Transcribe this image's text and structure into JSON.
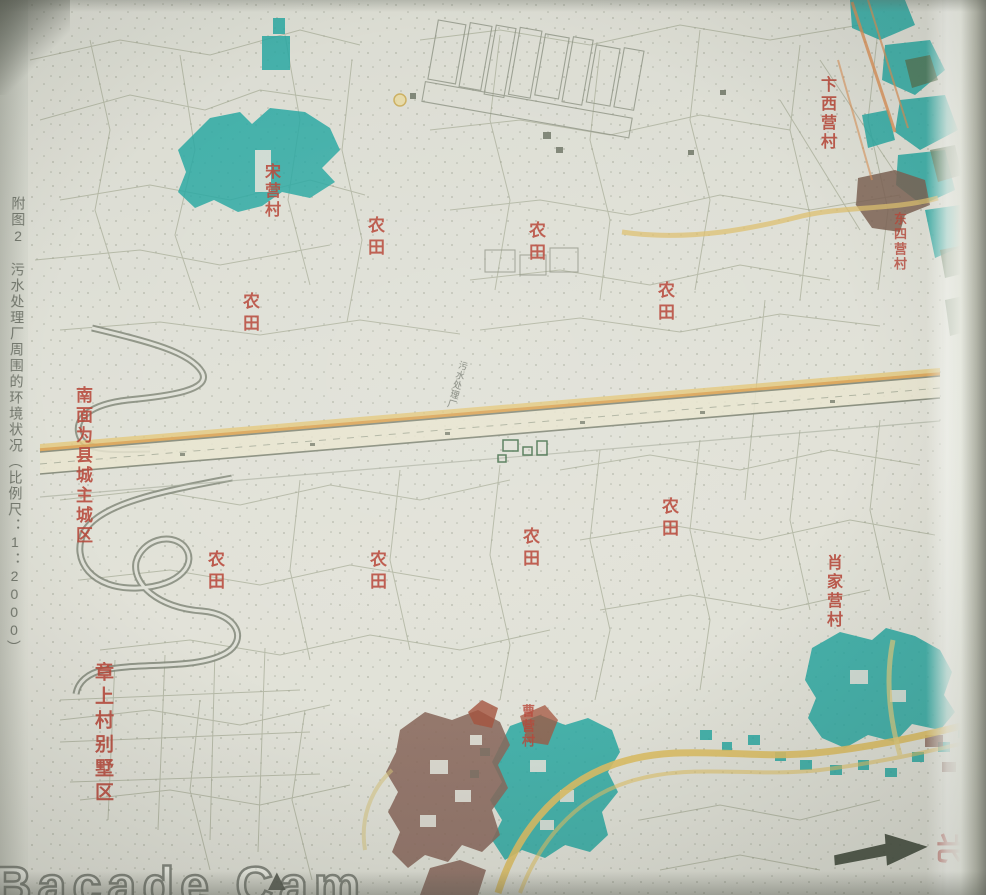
{
  "page": {
    "caption": "附图2　污水处理厂周围的环境状况（比例尺：1：2000）"
  },
  "map": {
    "labels": [
      {
        "name": "label-farmland-1",
        "text": "农田",
        "type": "farmland",
        "x": 366,
        "y": 216
      },
      {
        "name": "label-farmland-2",
        "text": "农田",
        "type": "farmland",
        "x": 527,
        "y": 221
      },
      {
        "name": "label-farmland-3",
        "text": "农田",
        "type": "farmland",
        "x": 656,
        "y": 281
      },
      {
        "name": "label-farmland-4",
        "text": "农田",
        "type": "farmland",
        "x": 241,
        "y": 292
      },
      {
        "name": "label-farmland-5",
        "text": "农田",
        "type": "farmland",
        "x": 206,
        "y": 550
      },
      {
        "name": "label-farmland-6",
        "text": "农田",
        "type": "farmland",
        "x": 368,
        "y": 550
      },
      {
        "name": "label-farmland-7",
        "text": "农田",
        "type": "farmland",
        "x": 521,
        "y": 527
      },
      {
        "name": "label-farmland-8",
        "text": "农田",
        "type": "farmland",
        "x": 660,
        "y": 497
      },
      {
        "name": "label-village-song",
        "text": "宋营村",
        "type": "village",
        "x": 262,
        "y": 163
      },
      {
        "name": "label-village-bianxi",
        "text": "卞西营村",
        "type": "village",
        "x": 818,
        "y": 76
      },
      {
        "name": "label-village-dongsi",
        "text": "东四营村",
        "type": "village-sm",
        "x": 893,
        "y": 212
      },
      {
        "name": "label-village-xiaojia",
        "text": "肖家营村",
        "type": "village",
        "x": 824,
        "y": 554
      },
      {
        "name": "label-village-cao",
        "text": "曹营村",
        "type": "village-sm",
        "x": 521,
        "y": 704
      },
      {
        "name": "label-note-south",
        "text": "南面为县城主城区",
        "type": "note",
        "x": 74,
        "y": 386
      },
      {
        "name": "label-estate-zhangshang",
        "text": "章上村别墅区",
        "type": "estate",
        "x": 93,
        "y": 662
      },
      {
        "name": "label-sewage-plant",
        "text": "污水处理厂",
        "type": "plant",
        "x": 452,
        "y": 360
      }
    ],
    "compass": {
      "north": "北"
    },
    "watermark": {
      "text": "Bacade Cam",
      "mark": "▲"
    }
  },
  "colors": {
    "paper": "#dcded4",
    "builtup_teal": "#2aa8a2",
    "builtup_brown": "#8a695c",
    "road_yellow": "#ddbf66",
    "road_orange": "#d98f55",
    "label_red": "#b8483a"
  }
}
